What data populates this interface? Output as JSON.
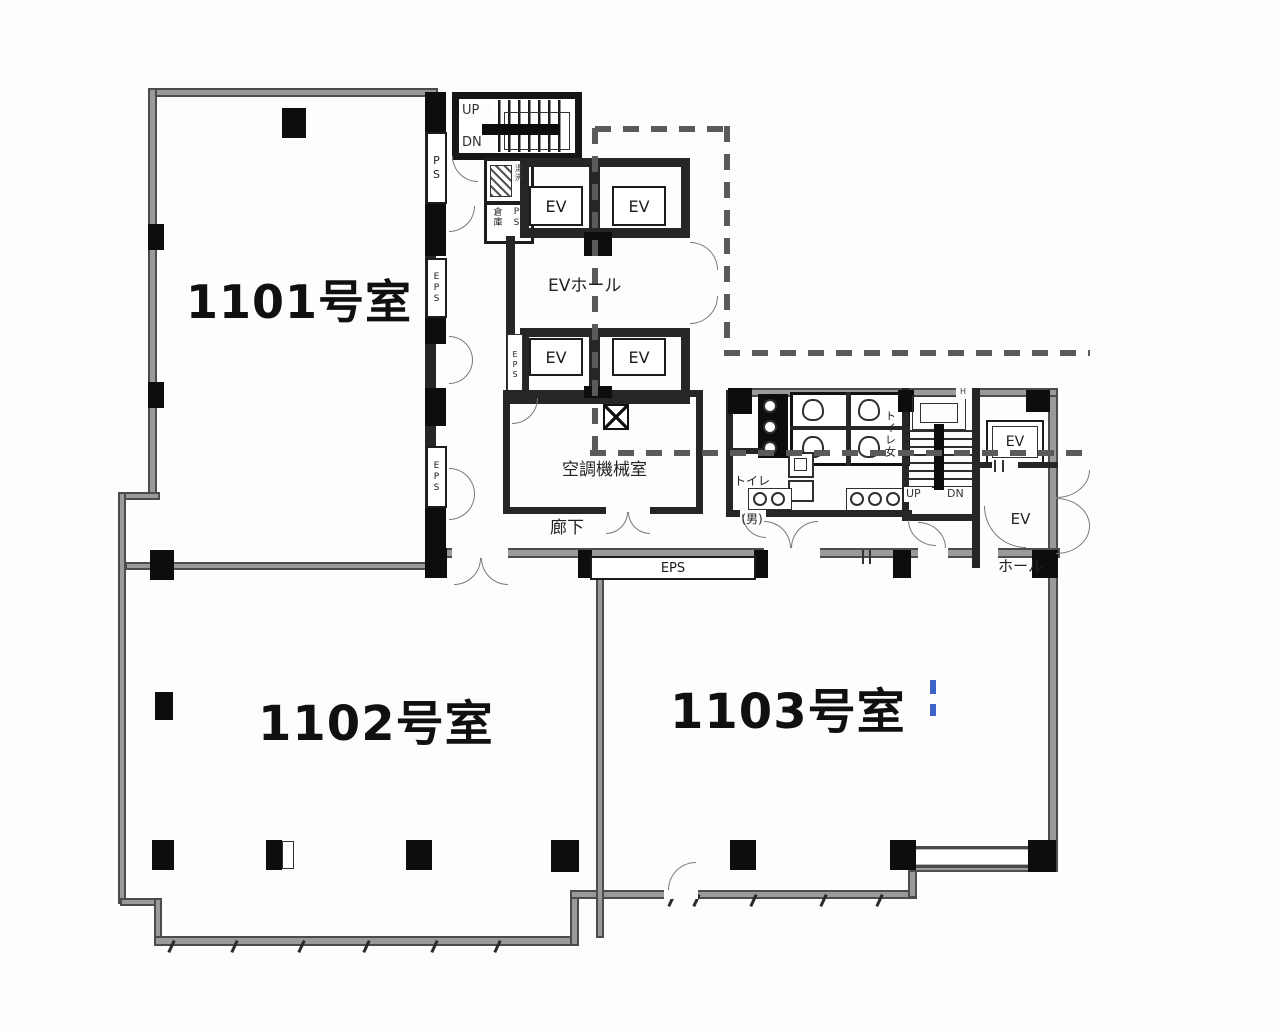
{
  "plan": {
    "rooms": {
      "r1101": "1101号室",
      "r1102": "1102号室",
      "r1103": "1103号室"
    },
    "stairs_top": {
      "up": "UP",
      "dn": "DN"
    },
    "left_shafts": {
      "ps": "PS",
      "eps_upper": "EPS",
      "eps_lower": "EPS"
    },
    "service": {
      "pantry": "湯沸",
      "storage": "倉庫",
      "ps": "PS"
    },
    "ev_bank": {
      "ev": "EV",
      "hall": "EVホール",
      "eps": "EPS"
    },
    "hvac": {
      "name": "空調機械室"
    },
    "corridor": {
      "name": "廊下",
      "eps": "EPS"
    },
    "toilets": {
      "men_line1": "トイレ",
      "men_line2": "(男)",
      "women": "トイレ女"
    },
    "stairs_right": {
      "up": "UP",
      "dn": "DN",
      "h": "H"
    },
    "ev_right": {
      "ev": "EV",
      "hall_line1": "EV",
      "hall_line2": "ホール"
    }
  }
}
